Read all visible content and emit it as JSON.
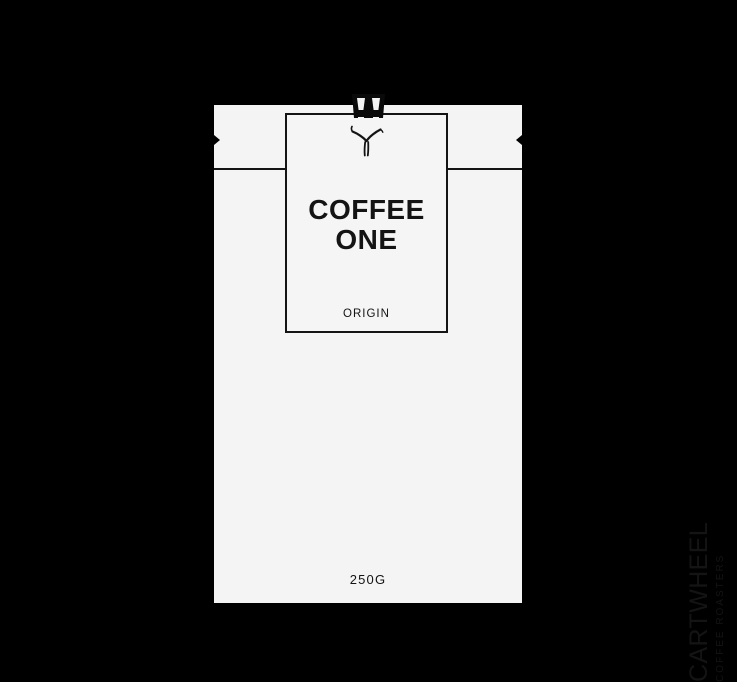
{
  "colors": {
    "background": "#000000",
    "bag": "#f4f4f4",
    "label_bg": "#f5f5f5",
    "ink": "#141414"
  },
  "bag": {
    "label": {
      "title_line1": "COFFEE",
      "title_line2": "ONE",
      "subtitle": "ORIGIN"
    },
    "weight": "250G",
    "brand": {
      "name": "CARTWHEEL",
      "tagline": "COFFEE ROASTERS"
    },
    "icons": {
      "clip": "bag-clip",
      "figure": "cartwheel-figure"
    }
  }
}
